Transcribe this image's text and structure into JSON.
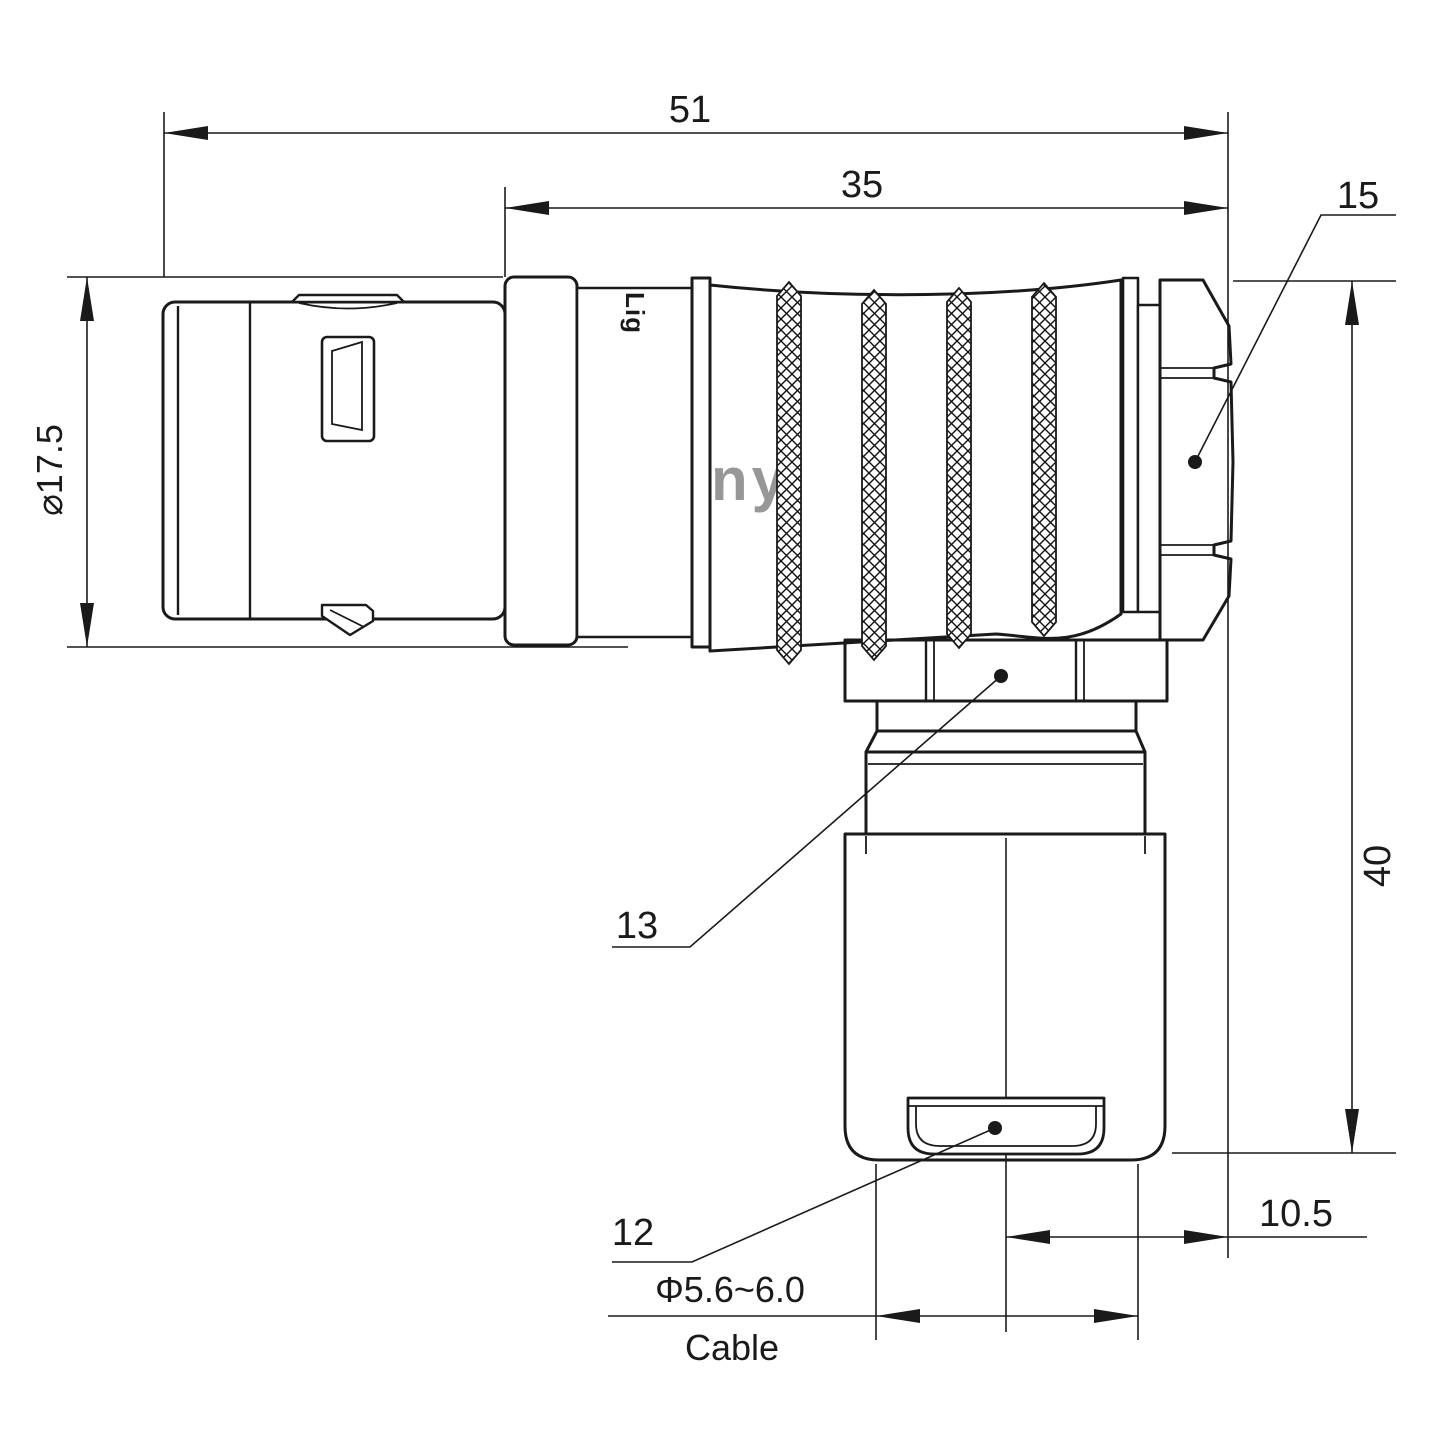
{
  "dimensions": {
    "total_length": "51",
    "front_length": "35",
    "height": "40",
    "side_offset": "10.5",
    "shell_diameter": "⌀17.5",
    "cable_diameter": "Φ5.6~6.0",
    "cable_caption": "Cable"
  },
  "part_refs": {
    "elbow_nut": "15",
    "clamp_nut": "13",
    "cable_bushing": "12"
  },
  "branding": {
    "watermark": "Lightany",
    "body_print": "Lig"
  },
  "colors": {
    "line_color": "#1a1a1a",
    "watermark_color": "#f0bcbc",
    "background": "#ffffff"
  }
}
